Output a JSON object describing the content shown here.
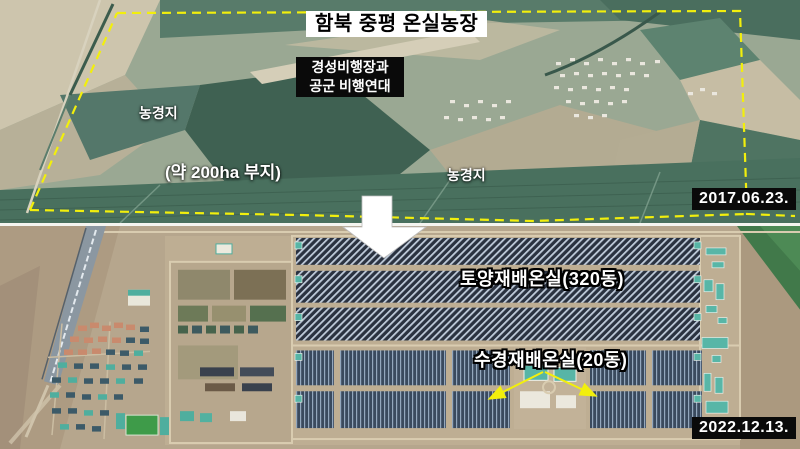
{
  "page": {
    "title": "함북 중평 온실농장"
  },
  "top_panel": {
    "name": "satellite-before-2017",
    "title": "함북 중평 온실농장",
    "airfield_line1": "경성비행장과",
    "airfield_line2": "공군 비행연대",
    "farmland_left": "농경지",
    "farmland_right": "농경지",
    "area_note": "(약 200ha 부지)",
    "date": "2017.06.23."
  },
  "bottom_panel": {
    "name": "satellite-after-2022",
    "soil_greenhouse": "토양재배온실(320동)",
    "hydroponic_greenhouse": "수경재배온실(20동)",
    "date": "2022.12.13."
  },
  "colors": {
    "boundary_yellow": "#f2ef0c",
    "pointer_arrow_yellow": "#f2ef0c",
    "transition_arrow_white": "#ffffff",
    "label_box_black": "#0a0a0a",
    "label_text_white": "#ffffff"
  }
}
